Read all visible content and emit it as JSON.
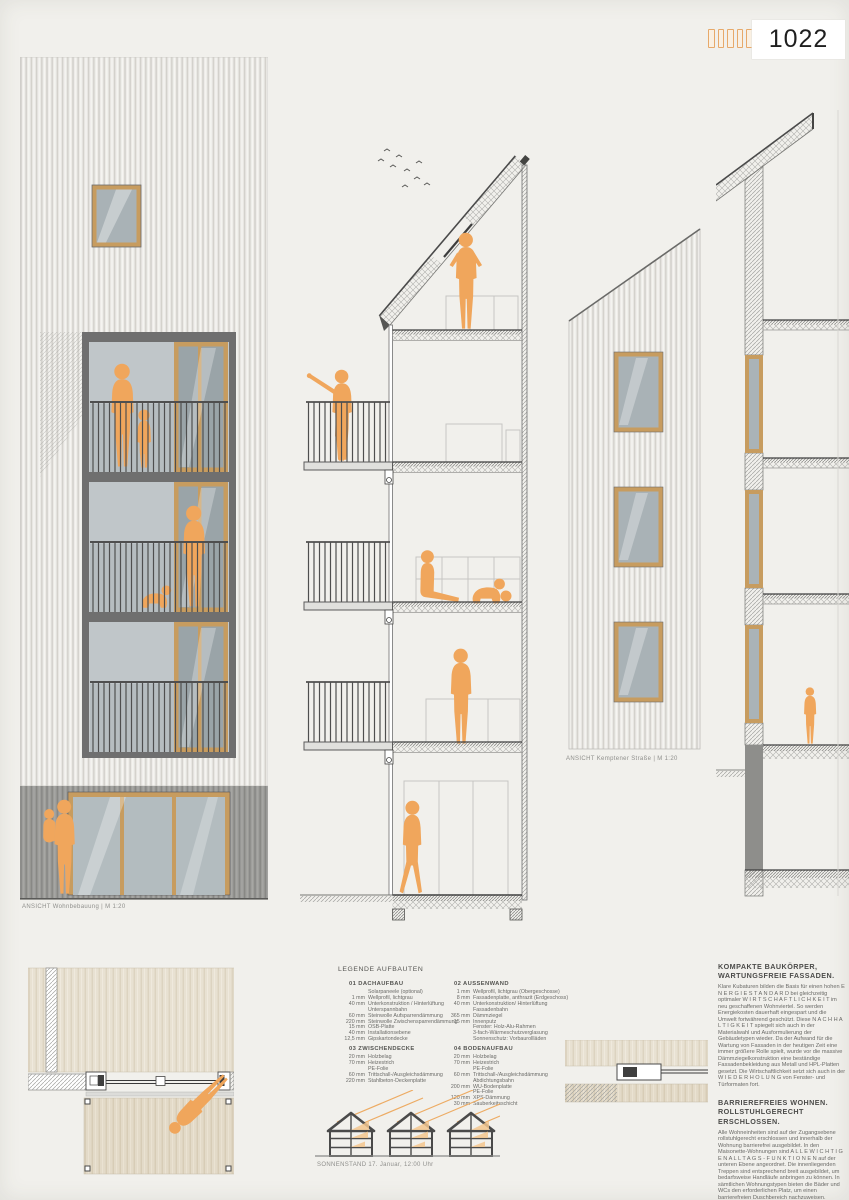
{
  "header": {
    "page_number": "1022",
    "tick_count": 6
  },
  "captions": {
    "left_elevation": "ANSICHT Wohnbebauung  | M 1:20",
    "street_elevation": "ANSICHT Kemptener Straße  | M 1:20",
    "sun_study": "SONNENSTAND 17. Januar, 12:00 Uhr"
  },
  "legend": {
    "title": "LEGENDE AUFBAUTEN",
    "sections": [
      {
        "title": "01 DACHAUFBAU",
        "rows": [
          [
            "",
            "Solarpaneele (optional)"
          ],
          [
            "1 mm",
            "Wellprofil, lichtgrau"
          ],
          [
            "40 mm",
            "Unterkonstruktion / Hinterlüftung"
          ],
          [
            "",
            "Unterspannbahn"
          ],
          [
            "60 mm",
            "Steinwolle Aufsparrendämmung"
          ],
          [
            "220 mm",
            "Steinwolle Zwischensparrendämmung"
          ],
          [
            "15 mm",
            "OSB-Platte"
          ],
          [
            "40 mm",
            "Installationsebene"
          ],
          [
            "12,5 mm",
            "Gipskartondecke"
          ]
        ]
      },
      {
        "title": "02 AUSSENWAND",
        "rows": [
          [
            "1 mm",
            "Wellprofil, lichtgrau (Obergeschosse)"
          ],
          [
            "8 mm",
            "Fassadenplatte, anthrazit (Erdgeschoss)"
          ],
          [
            "40 mm",
            "Unterkonstruktion/ Hinterlüftung"
          ],
          [
            "",
            "Fassadenbahn"
          ],
          [
            "365 mm",
            "Dämmziegel"
          ],
          [
            "15 mm",
            "Innenputz"
          ],
          [
            "",
            "Fenster: Holz-Alu-Rahmen"
          ],
          [
            "",
            "3-fach-Wärmeschutzverglasung"
          ],
          [
            "",
            "Sonnenschutz: Vorbaurollläden"
          ]
        ]
      },
      {
        "title": "03 ZWISCHENDECKE",
        "rows": [
          [
            "20 mm",
            "Holzbelag"
          ],
          [
            "70 mm",
            "Heizestrich"
          ],
          [
            "",
            "PE-Folie"
          ],
          [
            "60 mm",
            "Trittschall-/Ausgleichsdämmung"
          ],
          [
            "220 mm",
            "Stahlbeton-Deckenplatte"
          ]
        ]
      },
      {
        "title": "04 BODENAUFBAU",
        "rows": [
          [
            "20 mm",
            "Holzbelag"
          ],
          [
            "70 mm",
            "Heizestrich"
          ],
          [
            "",
            "PE-Folie"
          ],
          [
            "60 mm",
            "Trittschall-/Ausgleichsdämmung"
          ],
          [
            "",
            "Abdichtungsbahn"
          ],
          [
            "200 mm",
            "WU-Bodenplatte"
          ],
          [
            "",
            "PE-Folie"
          ],
          [
            "120 mm",
            "XPS-Dämmung"
          ],
          [
            "30 mm",
            "Sauberkeitsschicht"
          ]
        ]
      }
    ]
  },
  "articles": [
    {
      "title": "KOMPAKTE BAUKÖRPER, WARTUNGSFREIE FASSADEN.",
      "body": "Klare Kubaturen bilden die Basis für einen hohen E N E R G I E S T A N D A R D bei gleichzeitig optimaler W I R T S C H A F T L I C H K E I T im neu geschaffenen Wohnviertel. So werden Energiekosten dauerhaft eingespart und die Umwelt fortwährend geschützt. Diese N A C H H A L T I G K E I T spiegelt sich auch in der Materialwahl und Ausformulierung der Gebäudetypen wieder. Da der Aufwand für die Wartung von Fassaden in der heutigen Zeit eine immer größere Rolle spielt, wurde vor die massive Dämmziegelkonstruktion eine beständige Fassadenbekleidung aus Metall und HPL-Platten gesetzt. Die Wirtschaftlichkeit setzt sich auch in der W I E D E R H O L U N G von Fenster- und Türformaten fort."
    },
    {
      "title": "BARRIEREFREIES WOHNEN. ROLLSTUHLGERECHT ERSCHLOSSEN.",
      "body": "Alle Wohneinheiten sind auf der Zugangsebene rollstuhlgerecht erschlossen und innerhalb der Wohnung barrierefrei ausgebildet. In den Maisonette-Wohnungen sind A L L E  W I C H T I G E N  A L L T A G S - F U N K T I O N E N auf der unteren Ebene angeordnet. Die innenliegenden Treppen sind entsprechend breit ausgebildet, um bedarfsweise Handläufe anbringen zu können. In sämtlichen Wohnungstypen bieten die Bäder und WCs den erforderlichen Platz, um einen barrierefreien Duschbereich nachzuweisen."
    }
  ],
  "colors": {
    "accent_orange": "#f0a65c",
    "ray_orange": "#edab63",
    "frame_tan": "#c79c5f",
    "frame_gray": "#6f6f6f",
    "glass_gray": "#aab3b7",
    "paper": "#f1f0ec"
  }
}
